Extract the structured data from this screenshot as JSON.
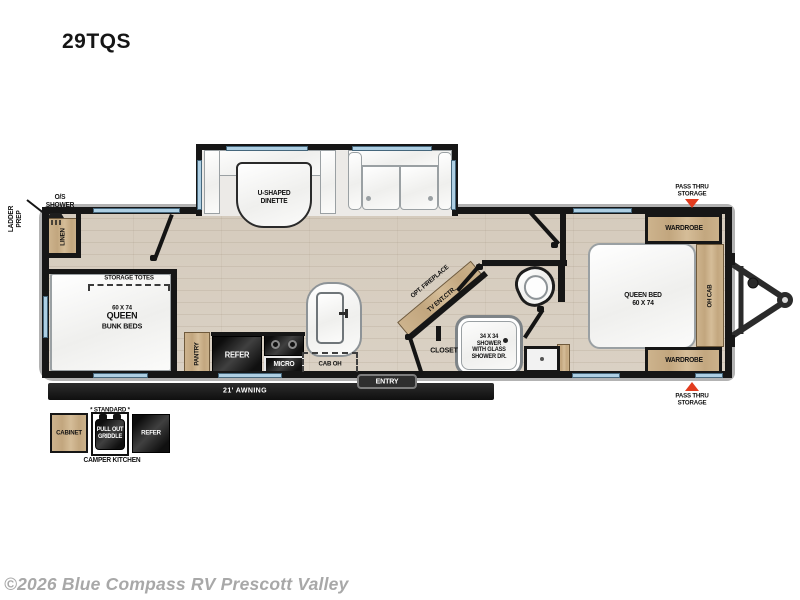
{
  "title": "29TQS",
  "watermark": "©2026 Blue Compass RV Prescott Valley",
  "colors": {
    "wood": "#c7ad89",
    "appliance": "#1e1e1e",
    "wall": "#161616",
    "floor": "#d8cfc2",
    "window": "#aecfe3",
    "arrow": "#e23b1e",
    "watermark": "#a8a8a8"
  },
  "exterior": {
    "ladder_prep": "LADDER\nPREP",
    "os_shower": "O/S\nSHOWER",
    "pass_thru_top": "PASS THRU\nSTORAGE",
    "pass_thru_bottom": "PASS THRU\nSTORAGE",
    "awning": "21' AWNING",
    "entry": "ENTRY"
  },
  "bunk_room": {
    "linen": "LINEN",
    "storage_totes": "STORAGE TOTES",
    "bunk_bed_size": "60 X 74",
    "bunk_bed_type": "QUEEN",
    "bunk_bed_sub": "BUNK BEDS"
  },
  "kitchen": {
    "dinette": "U-SHAPED\nDINETTE",
    "pantry": "PANTRY",
    "refer": "REFER",
    "micro": "MICRO",
    "cab_oh": "CAB OH"
  },
  "living": {
    "opt_fireplace": "OPT. FIREPLACE",
    "tv_ent_ctr": "TV ENT.CTR."
  },
  "bathroom": {
    "closet": "CLOSET",
    "shower": "34 X 34\nSHOWER\nWITH GLASS\nSHOWER DR."
  },
  "bedroom": {
    "queen_bed": "QUEEN BED\n60 X 74",
    "wardrobe_top": "WARDROBE",
    "wardrobe_bottom": "WARDROBE",
    "oh_cab": "OH CAB"
  },
  "camper_kitchen": {
    "standard": "* STANDARD *",
    "cabinet": "CABINET",
    "griddle": "PULL OUT\nGRIDDLE",
    "refer": "REFER",
    "caption": "CAMPER KITCHEN"
  }
}
